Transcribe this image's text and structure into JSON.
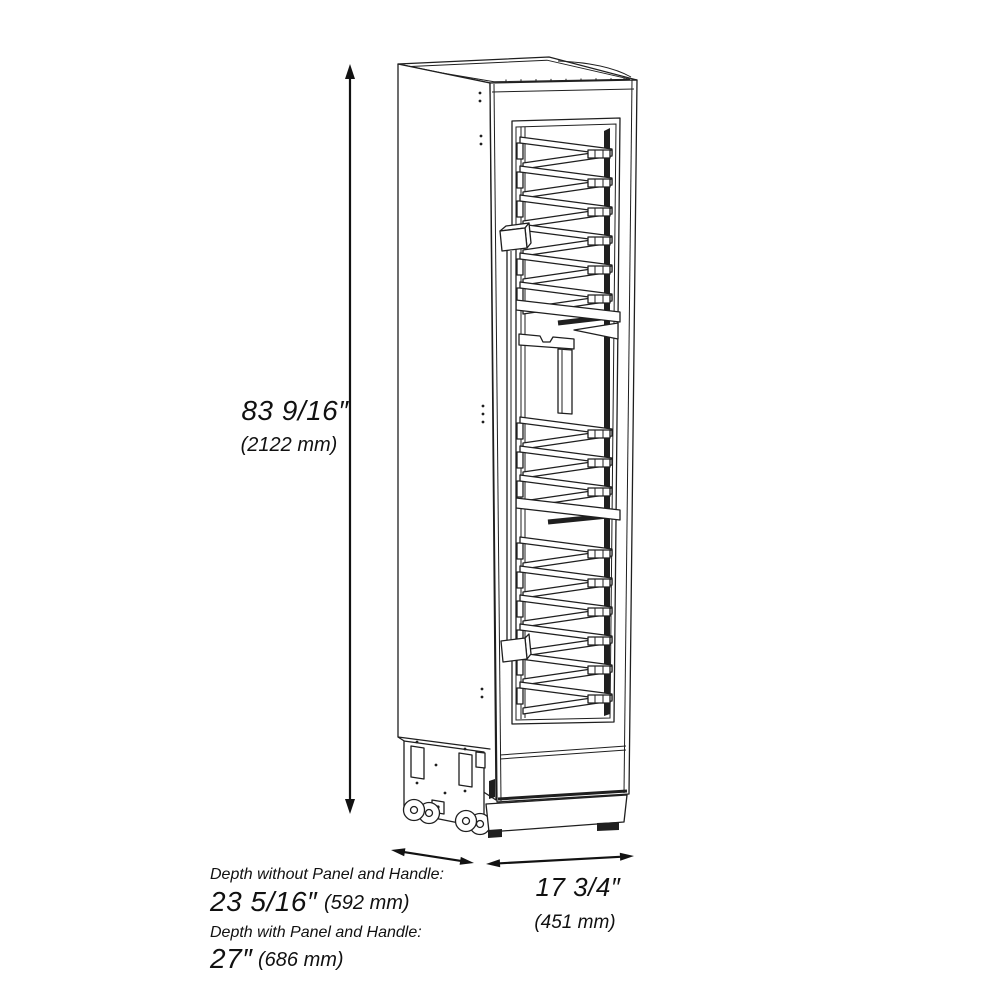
{
  "meta": {
    "background_color": "#ffffff",
    "line_color": "#1f1f1f",
    "text_color": "#111111",
    "figure": "tall-wine-cooler-isometric-line-drawing"
  },
  "dimensions": {
    "height": {
      "inches": "83 9/16″",
      "mm": "(2122 mm)"
    },
    "depth_without_panel": {
      "label": "Depth without Panel and Handle:",
      "inches": "23 5/16″",
      "mm": "(592 mm)"
    },
    "depth_with_panel": {
      "label": "Depth with Panel and Handle:",
      "inches": "27″",
      "mm": "(686 mm)"
    },
    "width": {
      "inches": "17 3/4″",
      "mm": "(451 mm)"
    }
  }
}
